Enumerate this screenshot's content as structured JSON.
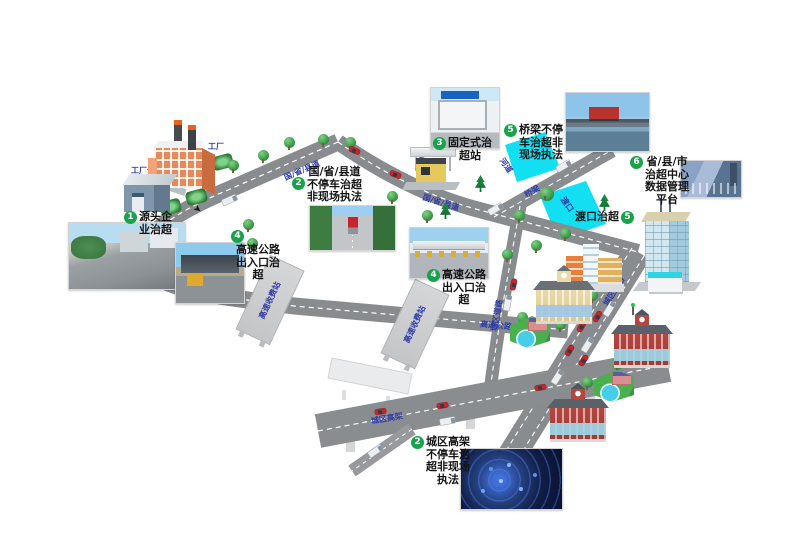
{
  "colors": {
    "badge_green": "#17a24b",
    "road_label_blue": "#2e3ba8",
    "road_gray": "#898c8f",
    "water_cyan": "#12dff2"
  },
  "icons": {
    "flow_arrow": "➤"
  },
  "annotations": {
    "source": {
      "num": "1",
      "text": "源头企\n业治超"
    },
    "road_nonstop": {
      "num": "2",
      "text": "国/省/县道\n不停车治超\n非现场执法"
    },
    "fixed_station": {
      "num": "3",
      "text": "固定式治\n超站"
    },
    "highway_exit": {
      "num": "4",
      "text": "高速公路\n出入口治\n超"
    },
    "bridge_nonstop": {
      "num": "5",
      "text": "桥梁不停\n车治超非\n现场执法"
    },
    "ferry": {
      "num": "5",
      "text": "渡口治超"
    },
    "data_center": {
      "num": "6",
      "text": "省/县/市\n治超中心\n数据管理\n平台"
    },
    "urban_elevated": {
      "num": "2",
      "text": "城区高架\n不停车治\n超非现场\n执法"
    }
  },
  "map_labels": {
    "factory": "工厂",
    "warehouse": "工厂仓库",
    "provincial_road": "国/省/县道",
    "highway": "高速公路",
    "toll_gate": "高速收费站",
    "viaduct": "城区高架",
    "urban_road": "城区道路",
    "bridge": "桥梁",
    "river": "河道",
    "ferry": "渡口"
  }
}
